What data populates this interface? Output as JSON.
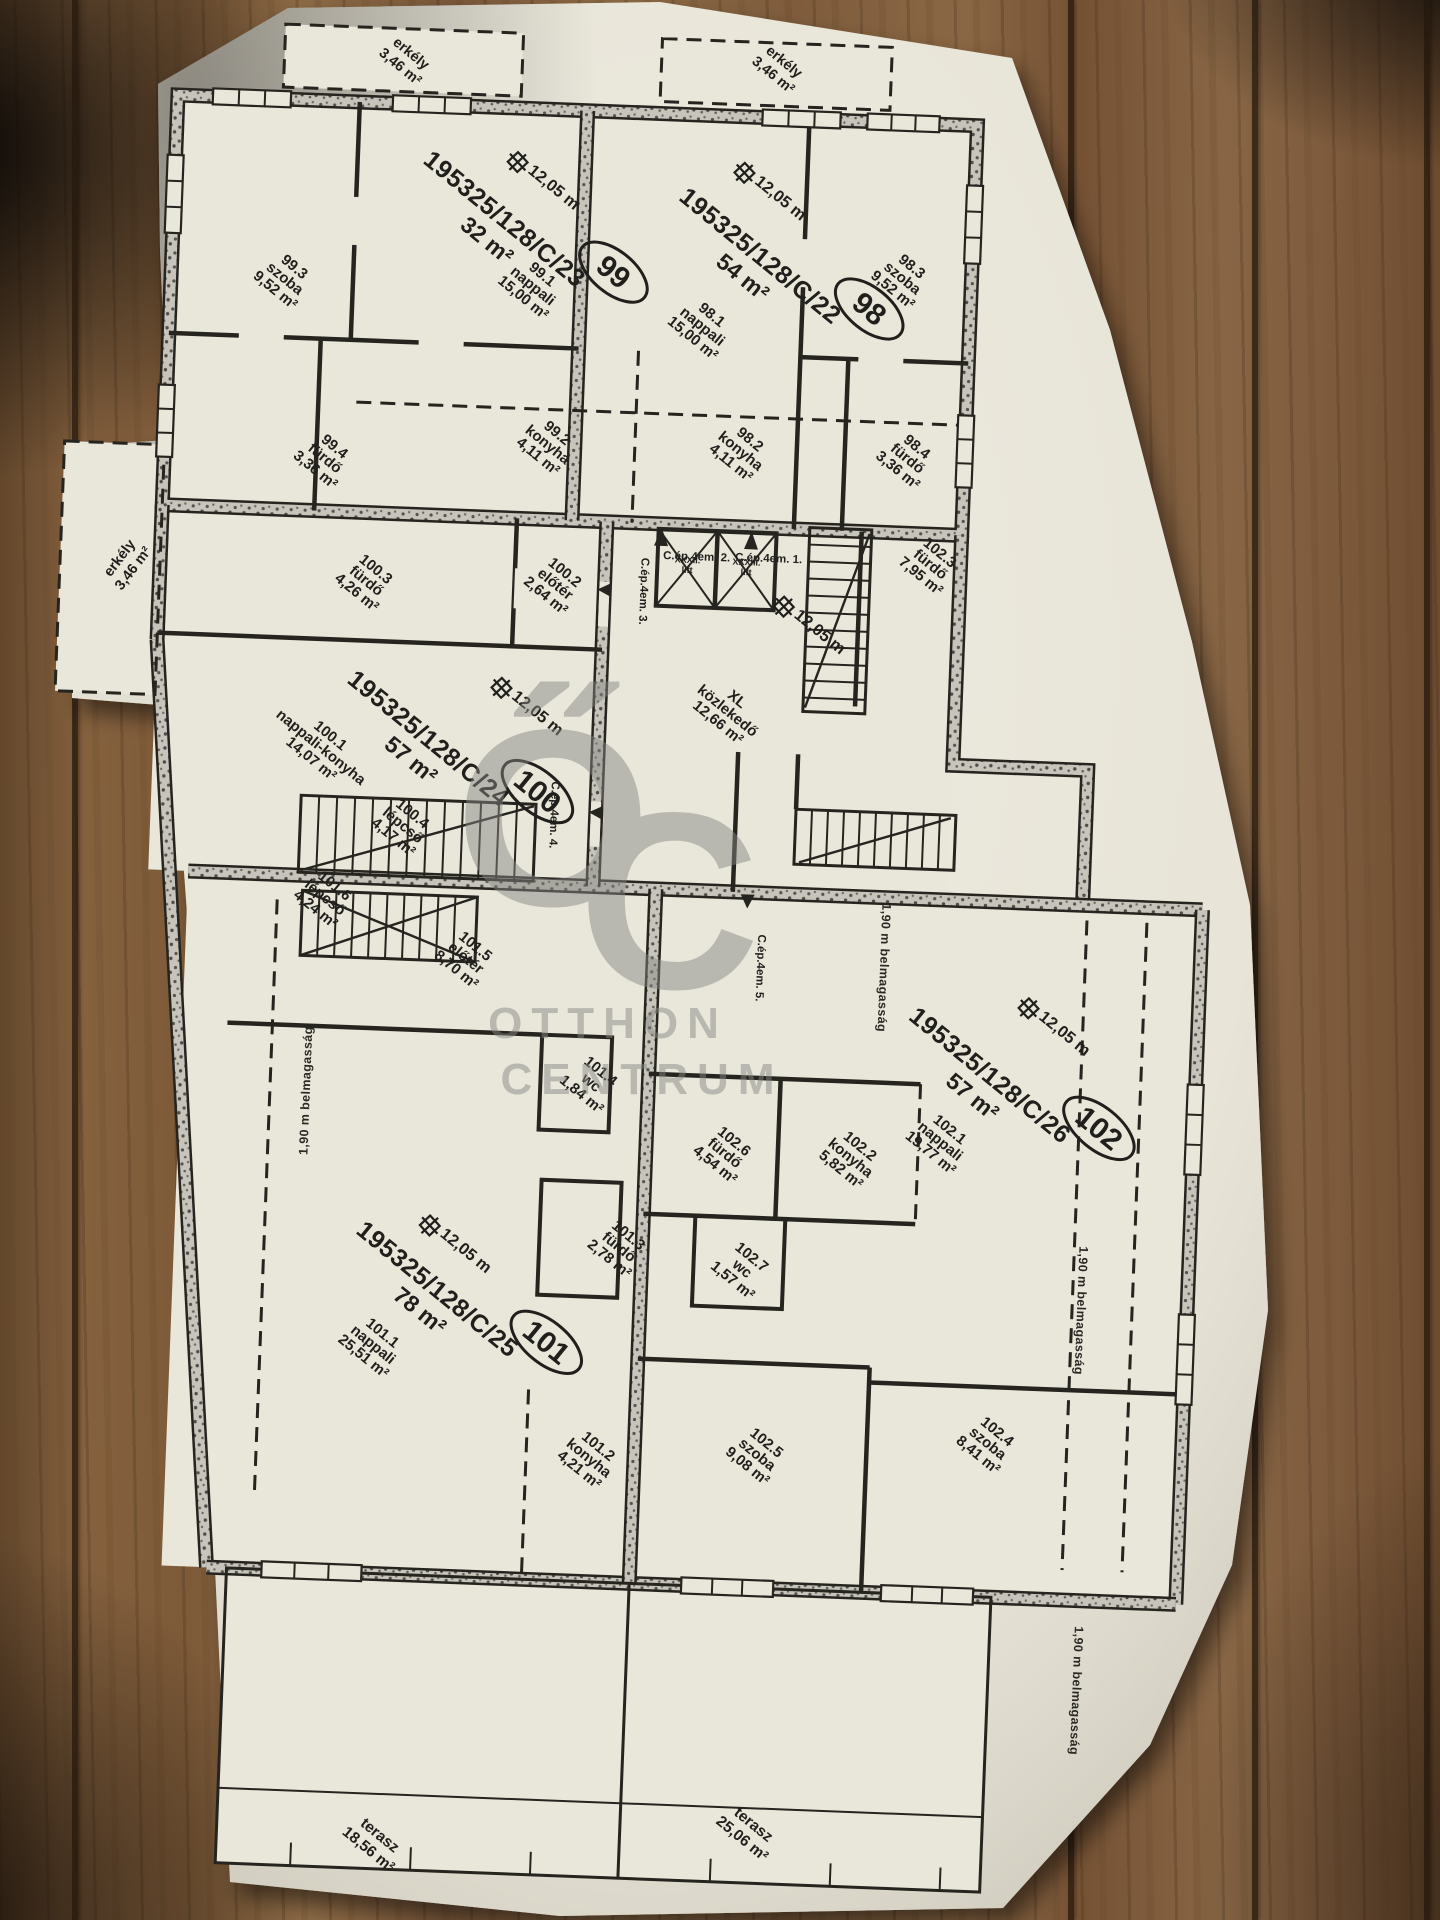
{
  "watermark": {
    "o": "Ő",
    "c": "C",
    "line1": "OTTHON",
    "line2": "CENTRUM"
  },
  "balcony": {
    "name": "erkély",
    "area": "3,46 m²"
  },
  "hall": {
    "line1": "XL",
    "line2": "közlekedő",
    "area": "12,66 m²"
  },
  "lifts": [
    {
      "no": "XXXII.",
      "label": "lift"
    },
    {
      "no": "XXXIII.",
      "label": "lift"
    }
  ],
  "marker_height": "12,05 m",
  "headroom": "1,90 m belmagasság",
  "doors": [
    "C.ép.4em. 1.",
    "C.ép.4em. 2.",
    "C.ép.4em. 3.",
    "C.ép.4em. 4.",
    "C.ép.4em. 5."
  ],
  "terraces": [
    {
      "name": "terasz",
      "area": "18,56 m²"
    },
    {
      "name": "terasz",
      "area": "25,06 m²"
    }
  ],
  "apartments": [
    {
      "id": "98",
      "lot": "195325/128/C/22",
      "area": "54 m²",
      "rooms": [
        {
          "no": "98.1",
          "name": "nappali",
          "area": "15,00 m²"
        },
        {
          "no": "98.2",
          "name": "konyha",
          "area": "4,11 m²"
        },
        {
          "no": "98.3",
          "name": "szoba",
          "area": "9,52 m²"
        },
        {
          "no": "98.4",
          "name": "fürdő",
          "area": "3,36 m²"
        }
      ]
    },
    {
      "id": "99",
      "lot": "195325/128/C/23",
      "area": "32 m²",
      "rooms": [
        {
          "no": "99.1",
          "name": "nappali",
          "area": "15,00 m²"
        },
        {
          "no": "99.2",
          "name": "konyha",
          "area": "4,11 m²"
        },
        {
          "no": "99.3",
          "name": "szoba",
          "area": "9,52 m²"
        },
        {
          "no": "99.4",
          "name": "fürdő",
          "area": "3,36 m²"
        }
      ]
    },
    {
      "id": "100",
      "lot": "195325/128/C/24",
      "area": "57 m²",
      "rooms": [
        {
          "no": "100.1",
          "name": "nappali-konyha",
          "area": "14,07 m²"
        },
        {
          "no": "100.2",
          "name": "előtér",
          "area": "2,64 m²"
        },
        {
          "no": "100.3",
          "name": "fürdő",
          "area": "4,26 m²"
        },
        {
          "no": "100.4",
          "name": "lépcső",
          "area": "4,17 m²"
        }
      ]
    },
    {
      "id": "101",
      "lot": "195325/128/C/25",
      "area": "78 m²",
      "rooms": [
        {
          "no": "101.1",
          "name": "nappali",
          "area": "25,51 m²"
        },
        {
          "no": "101.2",
          "name": "konyha",
          "area": "4,21 m²"
        },
        {
          "no": "101.3",
          "name": "fürdő",
          "area": "2,78 m²"
        },
        {
          "no": "101.4",
          "name": "wc",
          "area": "1,84 m²"
        },
        {
          "no": "101.5",
          "name": "előtér",
          "area": "8,70 m²"
        },
        {
          "no": "101.6",
          "name": "lépcső",
          "area": "4,24 m²"
        }
      ]
    },
    {
      "id": "102",
      "lot": "195325/128/C/26",
      "area": "57 m²",
      "rooms": [
        {
          "no": "102.1",
          "name": "nappali",
          "area": "19,77 m²"
        },
        {
          "no": "102.2",
          "name": "konyha",
          "area": "5,82 m²"
        },
        {
          "no": "102.3",
          "name": "fürdő",
          "area": "7,95 m²"
        },
        {
          "no": "102.4",
          "name": "szoba",
          "area": "8,41 m²"
        },
        {
          "no": "102.5",
          "name": "szoba",
          "area": "9,08 m²"
        },
        {
          "no": "102.6",
          "name": "fürdő",
          "area": "4,54 m²"
        },
        {
          "no": "102.7",
          "name": "wc",
          "area": "1,57 m²"
        }
      ]
    }
  ]
}
